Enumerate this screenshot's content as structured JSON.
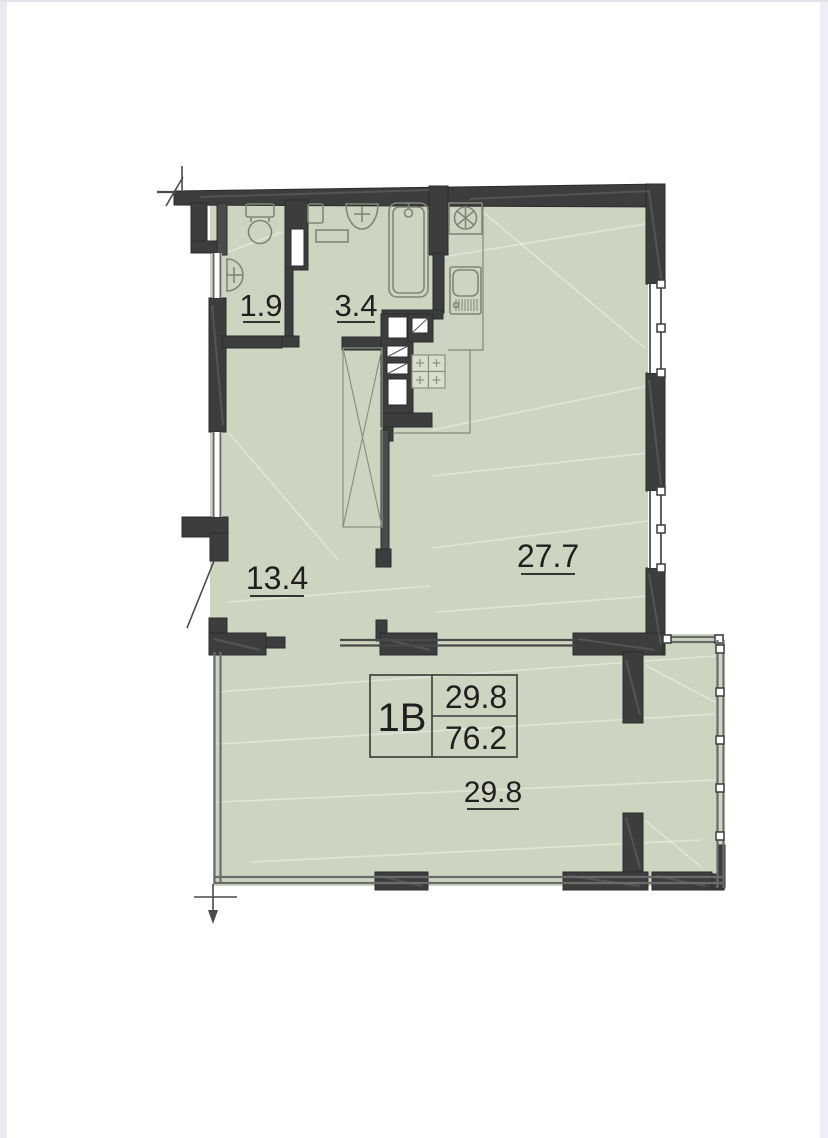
{
  "plan": {
    "type": "apartment-floor-plan",
    "info_box": {
      "unit": "1B",
      "living_area": "29.8",
      "total_area": "76.2"
    },
    "rooms": [
      {
        "key": "wc",
        "area": "1.9"
      },
      {
        "key": "bathroom",
        "area": "3.4"
      },
      {
        "key": "hallway",
        "area": "13.4"
      },
      {
        "key": "kitchen_living",
        "area": "27.7"
      },
      {
        "key": "bedroom",
        "area": "29.8"
      }
    ],
    "fixtures": [
      "toilet",
      "wc-washbasin",
      "washing-machine",
      "bath-washbasin",
      "bathtub",
      "fridge",
      "kitchen-sink",
      "stove",
      "wardrobe"
    ],
    "colors": {
      "room_fill": "#cdd5c0",
      "wall": "#3e3d3d",
      "fixture_outline": "#7f8878",
      "text": "#1f1f1f",
      "page_edge": "#e9ebf1"
    }
  }
}
